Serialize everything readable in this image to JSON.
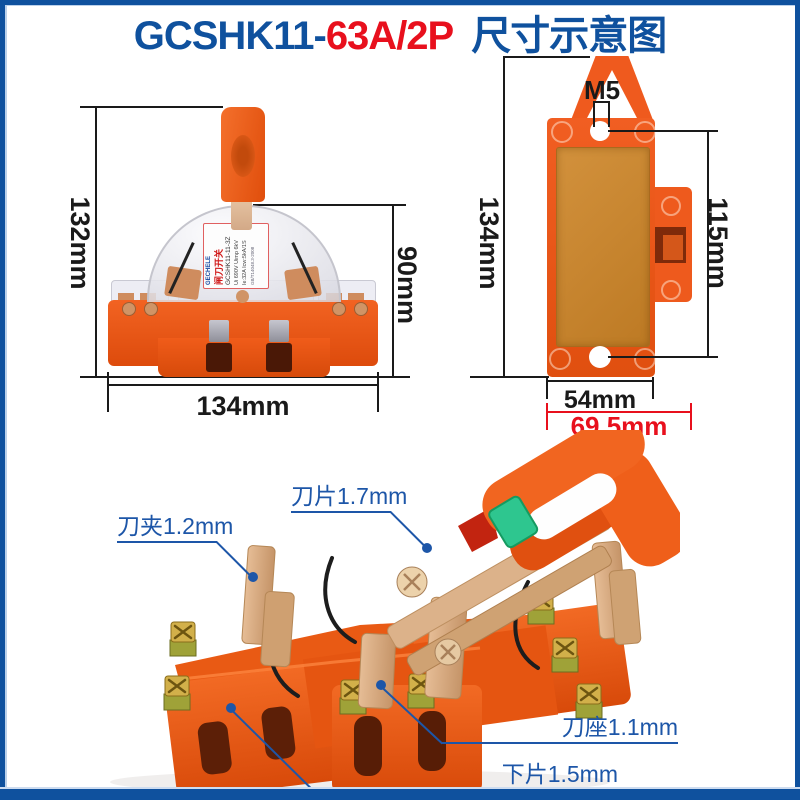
{
  "header": {
    "model_prefix": "GCSHK11-",
    "model_suffix": "63A/2P",
    "title": "尺寸示意图"
  },
  "front_view": {
    "dim_height": "132mm",
    "dim_cover_height": "90mm",
    "dim_width": "134mm",
    "label": {
      "brand": "GECHELE",
      "name": "闸刀开关",
      "model": "GCSHK11-11-3Z",
      "spec1": "Ui 690V Uimp 6kV",
      "spec2": "Ie:32A Icw:5kA/1S",
      "standard": "GB/T14048.3-2008"
    }
  },
  "back_view": {
    "dim_hole": "M5",
    "dim_height": "134mm",
    "dim_hole_spacing": "115mm",
    "dim_body_width": "54mm",
    "dim_total_width": "69.5mm"
  },
  "callouts": {
    "clamp": "刀夹1.2mm",
    "blade": "刀片1.7mm",
    "seat": "刀座1.1mm",
    "bottom_plate": "下片1.5mm"
  },
  "colors": {
    "frame_blue": "#0f519e",
    "title_red": "#e8101d",
    "dimension_black": "#1a1a1a",
    "dimension_red": "#e8101d",
    "callout_blue": "#1d56a8",
    "product_orange": "#ee5a1d",
    "board_brown": "#c9842e",
    "button_green": "#2ec68f"
  }
}
